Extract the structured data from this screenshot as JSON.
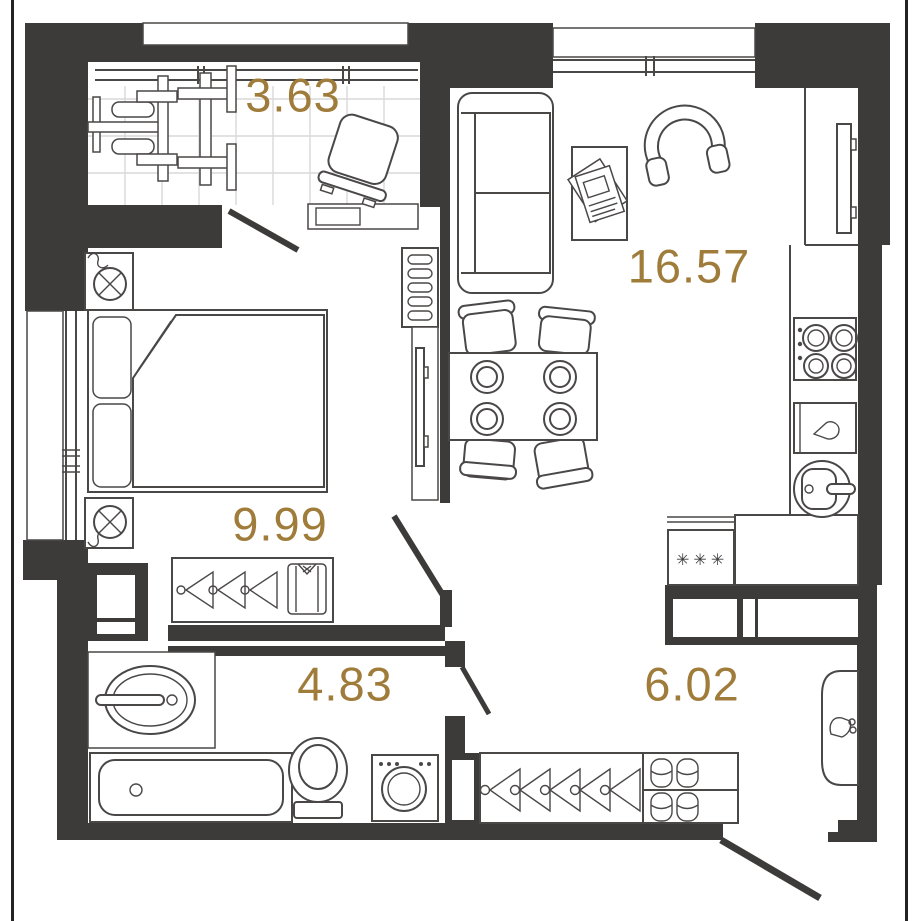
{
  "plan": {
    "type": "apartment-floor-plan",
    "area_unit": "m2",
    "rooms": [
      {
        "id": "loggia",
        "area": "3.63",
        "features": [
          "exercise-machine",
          "lounge-chair",
          "tiled-floor",
          "glazed-window-wall",
          "door-to-bedroom"
        ]
      },
      {
        "id": "living-kitchen",
        "area": "16.57",
        "features": [
          "sofa",
          "coffee-table",
          "magazine",
          "armchair",
          "dining-table",
          "four-plates",
          "four-chairs",
          "wall-tv",
          "kitchen-hob",
          "kitchen-base-cabinet",
          "kitchen-round-sink",
          "fridge-freezer",
          "kitchen-counter",
          "window"
        ]
      },
      {
        "id": "bedroom",
        "area": "9.99",
        "features": [
          "double-bed",
          "two-pillows",
          "two-nightstands-with-lamps",
          "wardrobe-with-hangers",
          "folded-shirt",
          "radiator",
          "tv-niche",
          "window",
          "door"
        ]
      },
      {
        "id": "bathroom",
        "area": "4.83",
        "features": [
          "vanity-sink",
          "bathtub",
          "toilet",
          "washing-machine",
          "ventilation-shaft",
          "door"
        ]
      },
      {
        "id": "hallway",
        "area": "6.02",
        "features": [
          "built-in-closet",
          "open-wardrobe-hangers",
          "shoe-shelf",
          "doorbell-panel",
          "entrance-door"
        ]
      }
    ],
    "fridge_marking": "✳✳✳",
    "colors": {
      "walls": "#3d3a3a",
      "area_labels": "#a07c3b",
      "furniture_lines": "#4a4747",
      "tile_grid": "#d9d9d9",
      "background": "#ffffff",
      "boundary_line": "#242222"
    }
  }
}
